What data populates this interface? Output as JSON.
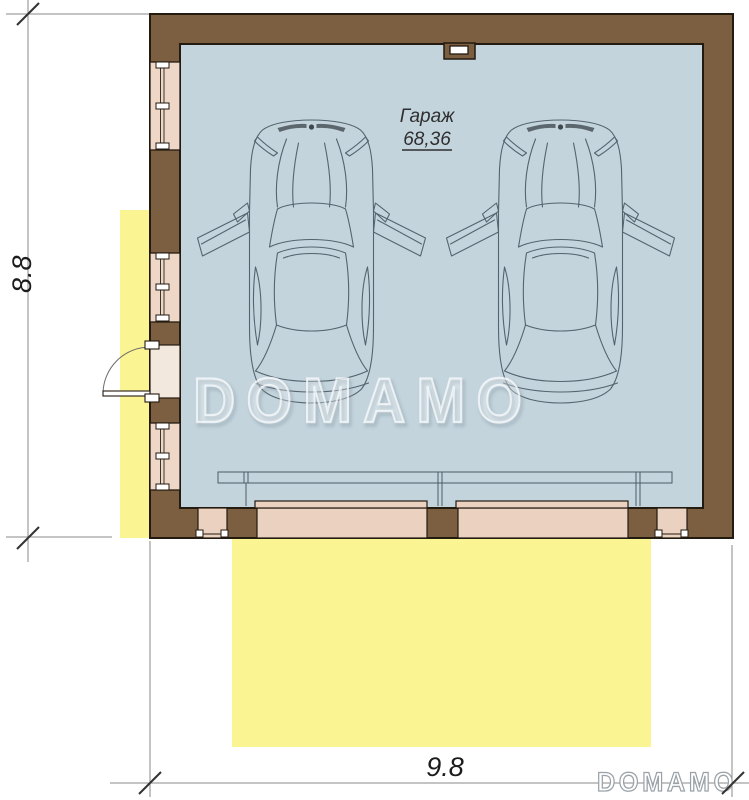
{
  "plan": {
    "type": "floor-plan",
    "room": {
      "label": "Гараж",
      "area": "68,36"
    },
    "dimensions": {
      "height": "8.8",
      "width": "9.8"
    },
    "watermark": {
      "center": "DOMAMO",
      "corner": "DOMAMO"
    },
    "features": {
      "cars": 2,
      "windows_left_wall": 3,
      "entry_door_left_wall": 1,
      "garage_door_openings": 2,
      "pedestrian_openings_bottom_wall": 2,
      "vent_top_wall": 1
    },
    "colors": {
      "wall_brown": "#7c5e40",
      "wall_outline": "#231a10",
      "opening_pink": "#ebd1bf",
      "window_pink": "#eed7c6",
      "door_cavity_pink": "#f3e8dd",
      "interior_blue": "#c3d4dd",
      "outdoor_yellow": "#fbf492",
      "drawing_line": "#46545f",
      "dimension_line": "#8a8a8a",
      "tick": "#333333",
      "watermark_stroke": "#9aa2a8"
    }
  }
}
